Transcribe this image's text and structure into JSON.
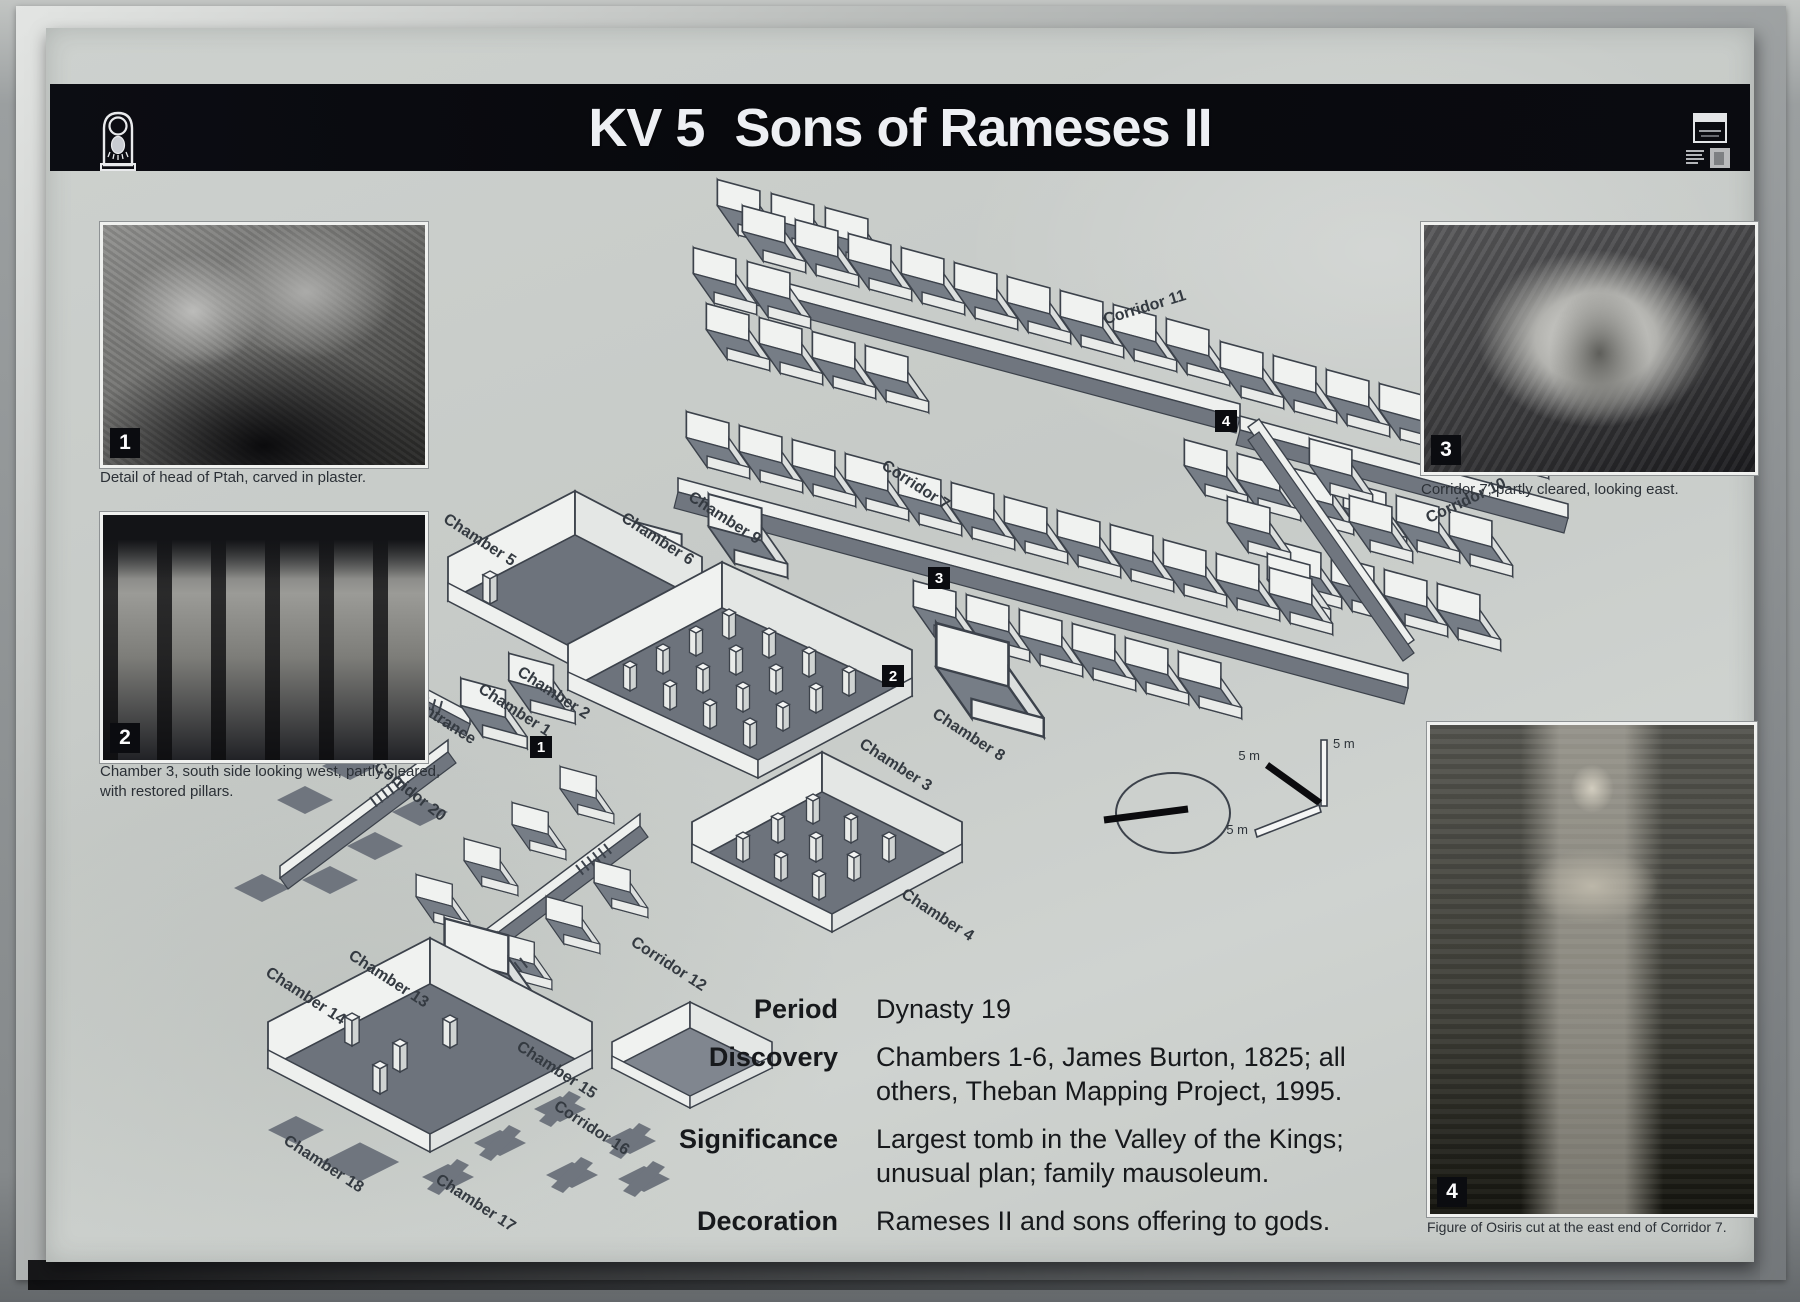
{
  "sign": {
    "title": {
      "catalog": "KV 5",
      "name": "Sons of Rameses II"
    },
    "header_icons": {
      "left": "cartouche-logo-icon",
      "right": "antiquities-logo-icon"
    },
    "photos": [
      {
        "number": "1",
        "caption": "Detail of head of Ptah, carved in plaster."
      },
      {
        "number": "2",
        "caption": "Chamber 3, south side looking west, partly cleared, with restored pillars."
      },
      {
        "number": "3",
        "caption": "Corridor 7, partly cleared, looking east."
      },
      {
        "number": "4",
        "caption": "Figure of Osiris cut at the east end of Corridor 7."
      }
    ],
    "diagram": {
      "labels": [
        {
          "text": "Corridor 11"
        },
        {
          "text": "Corridor 7"
        },
        {
          "text": "Corridor 10"
        },
        {
          "text": "Chamber 9"
        },
        {
          "text": "Chamber 6"
        },
        {
          "text": "Chamber 5"
        },
        {
          "text": "Chamber 2"
        },
        {
          "text": "Chamber 1"
        },
        {
          "text": "Entrance"
        },
        {
          "text": "Corridor 20"
        },
        {
          "text": "Chamber 8"
        },
        {
          "text": "Chamber 3"
        },
        {
          "text": "Chamber 4"
        },
        {
          "text": "Corridor 12"
        },
        {
          "text": "Chamber 13"
        },
        {
          "text": "Chamber 14"
        },
        {
          "text": "Chamber 15"
        },
        {
          "text": "Corridor 16"
        },
        {
          "text": "Chamber 18"
        },
        {
          "text": "Chamber 17"
        }
      ],
      "markers": [
        {
          "number": "1"
        },
        {
          "number": "2"
        },
        {
          "number": "3"
        },
        {
          "number": "4"
        }
      ],
      "scale": {
        "x": "5 m",
        "y": "5 m",
        "z": "5 m"
      },
      "compass_icon": "north-indicator-ellipse"
    },
    "info": {
      "rows": [
        {
          "label": "Period",
          "value": "Dynasty 19"
        },
        {
          "label": "Discovery",
          "value": "Chambers 1-6, James Burton, 1825; all others, Theban Mapping Project, 1995."
        },
        {
          "label": "Significance",
          "value": "Largest tomb in the Valley of the Kings; unusual plan; family mausoleum."
        },
        {
          "label": "Decoration",
          "value": "Rameses II and sons offering to gods."
        }
      ]
    },
    "colors": {
      "header_bg": "#0a0b10",
      "header_text": "#edeff3",
      "surface": "#c8ccc9",
      "diagram_floor": "#767d86",
      "diagram_wall": "#f0f2f0",
      "line": "#3c424b",
      "caption_text": "#2b3036"
    }
  }
}
